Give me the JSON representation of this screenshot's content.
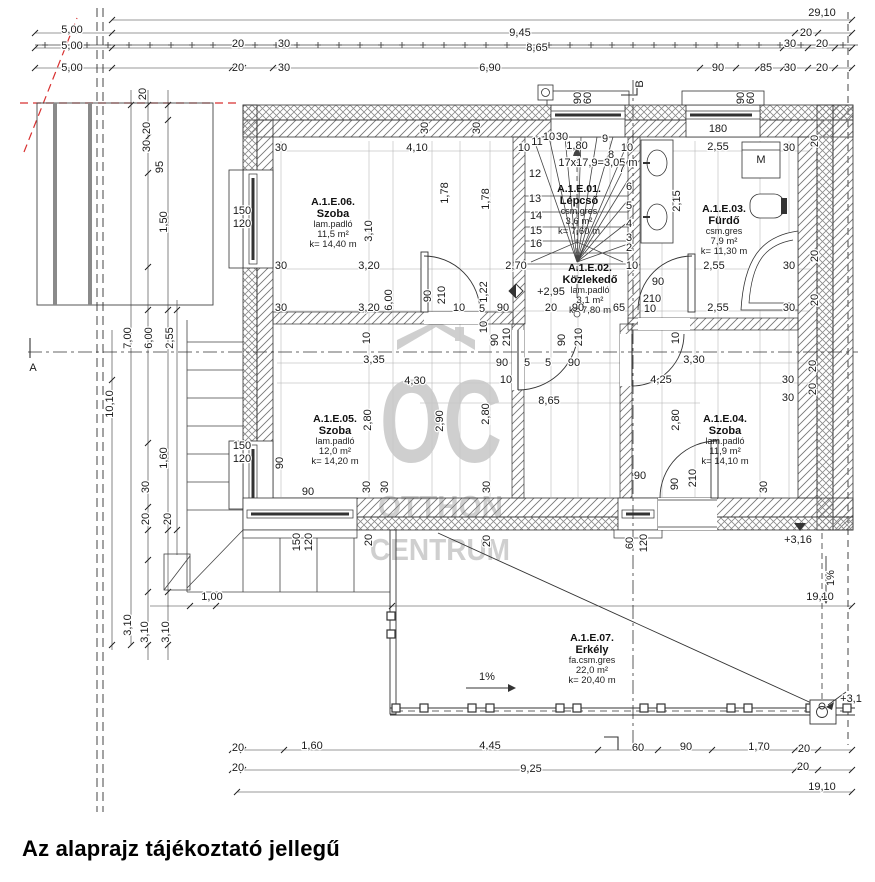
{
  "caption": "Az alaprajz tájékoztató jellegű",
  "watermark": {
    "icon": "house-roof-icon",
    "logo": "OC",
    "line1": "OTTHON",
    "line2": "CENTRUM"
  },
  "rooms": [
    {
      "code": "A.1.E.06.",
      "name": "Szoba",
      "floor": "lam.padló",
      "area": "11,5 m²",
      "perimeter": "k= 14,40 m",
      "x": 333,
      "y": 205
    },
    {
      "code": "A.1.E.01.",
      "name": "Lépcső",
      "floor": "csm.gres",
      "area": "3,6 m²",
      "perimeter": "k= 7,60 m",
      "x": 579,
      "y": 192
    },
    {
      "code": "A.1.E.03.",
      "name": "Fürdő",
      "floor": "csm.gres",
      "area": "7,9 m²",
      "perimeter": "k= 11,30 m",
      "x": 724,
      "y": 212
    },
    {
      "code": "A.1.E.02.",
      "name": "Közlekedő",
      "floor": "lam.padló",
      "area": "3,1 m²",
      "perimeter": "k= 7,80 m",
      "x": 590,
      "y": 271
    },
    {
      "code": "A.1.E.05.",
      "name": "Szoba",
      "floor": "lam.padló",
      "area": "12,0 m²",
      "perimeter": "k= 14,20 m",
      "x": 335,
      "y": 422
    },
    {
      "code": "A.1.E.04.",
      "name": "Szoba",
      "floor": "lam.padló",
      "area": "11,9 m²",
      "perimeter": "k= 14,10 m",
      "x": 725,
      "y": 422
    },
    {
      "code": "A.1.E.07.",
      "name": "Erkély",
      "floor": "fa.csm.gres",
      "area": "22,0 m²",
      "perimeter": "k= 20,40 m",
      "x": 592,
      "y": 641
    }
  ],
  "dims": [
    {
      "t": "29,10",
      "x": 822,
      "y": 16
    },
    {
      "t": "9,45",
      "x": 520,
      "y": 36
    },
    {
      "t": "20",
      "x": 806,
      "y": 36
    },
    {
      "t": "8,65",
      "x": 537,
      "y": 51
    },
    {
      "t": "30",
      "x": 790,
      "y": 47
    },
    {
      "t": "20",
      "x": 822,
      "y": 47
    },
    {
      "t": "5,00",
      "x": 72,
      "y": 33
    },
    {
      "t": "5,00",
      "x": 72,
      "y": 49
    },
    {
      "t": "5,00",
      "x": 72,
      "y": 71
    },
    {
      "t": "20",
      "x": 238,
      "y": 47
    },
    {
      "t": "30",
      "x": 284,
      "y": 47
    },
    {
      "t": "20",
      "x": 238,
      "y": 71
    },
    {
      "t": "30",
      "x": 284,
      "y": 71
    },
    {
      "t": "6,90",
      "x": 490,
      "y": 71
    },
    {
      "t": "90",
      "x": 718,
      "y": 71
    },
    {
      "t": "85",
      "x": 766,
      "y": 71
    },
    {
      "t": "30",
      "x": 790,
      "y": 71
    },
    {
      "t": "20",
      "x": 822,
      "y": 71
    },
    {
      "t": "90",
      "x": 581,
      "y": 98,
      "r": 1,
      "f": 8.5
    },
    {
      "t": "60",
      "x": 591,
      "y": 98,
      "r": 1,
      "f": 8.5
    },
    {
      "t": "90",
      "x": 744,
      "y": 98,
      "r": 1,
      "f": 8.5
    },
    {
      "t": "60",
      "x": 754,
      "y": 98,
      "r": 1,
      "f": 8.5
    },
    {
      "t": "B",
      "x": 643,
      "y": 84,
      "r": 1,
      "f": 12,
      "n": "section-marker-b"
    },
    {
      "t": "A",
      "x": 33,
      "y": 371,
      "f": 12,
      "n": "section-marker-a"
    },
    {
      "t": "20",
      "x": 146,
      "y": 94,
      "r": 1
    },
    {
      "t": "20",
      "x": 150,
      "y": 128,
      "r": 1
    },
    {
      "t": "30",
      "x": 150,
      "y": 146,
      "r": 1
    },
    {
      "t": "95",
      "x": 163,
      "y": 167,
      "r": 1
    },
    {
      "t": "1,50",
      "x": 167,
      "y": 222,
      "r": 1
    },
    {
      "t": "7,00",
      "x": 131,
      "y": 338,
      "r": 1
    },
    {
      "t": "6,00",
      "x": 152,
      "y": 338,
      "r": 1
    },
    {
      "t": "2,55",
      "x": 173,
      "y": 338,
      "r": 1
    },
    {
      "t": "10,10",
      "x": 113,
      "y": 404,
      "r": 1
    },
    {
      "t": "1,60",
      "x": 167,
      "y": 458,
      "r": 1
    },
    {
      "t": "30",
      "x": 149,
      "y": 487,
      "r": 1
    },
    {
      "t": "20",
      "x": 149,
      "y": 519,
      "r": 1
    },
    {
      "t": "20",
      "x": 171,
      "y": 519,
      "r": 1
    },
    {
      "t": "3,10",
      "x": 131,
      "y": 625,
      "r": 1
    },
    {
      "t": "3,10",
      "x": 148,
      "y": 632,
      "r": 1
    },
    {
      "t": "3,10",
      "x": 169,
      "y": 632,
      "r": 1
    },
    {
      "t": "30",
      "x": 281,
      "y": 151
    },
    {
      "t": "4,10",
      "x": 417,
      "y": 151
    },
    {
      "t": "30",
      "x": 428,
      "y": 128,
      "r": 1
    },
    {
      "t": "30",
      "x": 480,
      "y": 128,
      "r": 1
    },
    {
      "t": "10",
      "x": 524,
      "y": 151
    },
    {
      "t": "1,80",
      "x": 577,
      "y": 149
    },
    {
      "t": "10",
      "x": 627,
      "y": 151
    },
    {
      "t": "2,55",
      "x": 718,
      "y": 150
    },
    {
      "t": "30",
      "x": 789,
      "y": 151
    },
    {
      "t": "180",
      "x": 718,
      "y": 132,
      "f": 8.5
    },
    {
      "t": "20",
      "x": 818,
      "y": 141,
      "r": 1
    },
    {
      "t": "17x17,9=3,05 m",
      "x": 598,
      "y": 166,
      "f": 10.5
    },
    {
      "t": "1,78",
      "x": 448,
      "y": 193,
      "r": 1
    },
    {
      "t": "1,78",
      "x": 489,
      "y": 199,
      "r": 1
    },
    {
      "t": "2,15",
      "x": 680,
      "y": 201,
      "r": 1
    },
    {
      "t": "3,10",
      "x": 372,
      "y": 231,
      "r": 1
    },
    {
      "t": "150",
      "x": 242,
      "y": 214,
      "f": 8.5
    },
    {
      "t": "120",
      "x": 242,
      "y": 227,
      "f": 8.5
    },
    {
      "t": "30",
      "x": 281,
      "y": 269
    },
    {
      "t": "3,20",
      "x": 369,
      "y": 269
    },
    {
      "t": "2,70",
      "x": 516,
      "y": 269
    },
    {
      "t": "10",
      "x": 632,
      "y": 269
    },
    {
      "t": "2,55",
      "x": 714,
      "y": 269
    },
    {
      "t": "30",
      "x": 789,
      "y": 269
    },
    {
      "t": "20",
      "x": 818,
      "y": 256,
      "r": 1
    },
    {
      "t": "90",
      "x": 658,
      "y": 285,
      "f": 9.5
    },
    {
      "t": "210",
      "x": 652,
      "y": 302,
      "f": 9.5
    },
    {
      "t": "10",
      "x": 650,
      "y": 312,
      "f": 9.5
    },
    {
      "t": "90",
      "x": 431,
      "y": 296,
      "r": 1,
      "f": 9.5
    },
    {
      "t": "210",
      "x": 445,
      "y": 295,
      "r": 1,
      "f": 9.5
    },
    {
      "t": "10",
      "x": 459,
      "y": 311,
      "f": 9.5
    },
    {
      "t": "6,00",
      "x": 392,
      "y": 300,
      "r": 1
    },
    {
      "t": "1,22",
      "x": 487,
      "y": 292,
      "r": 1
    },
    {
      "t": "+2,95",
      "x": 551,
      "y": 295,
      "f": 11.5,
      "n": "elevation-mark"
    },
    {
      "t": "30",
      "x": 281,
      "y": 311
    },
    {
      "t": "3,20",
      "x": 369,
      "y": 311
    },
    {
      "t": "90",
      "x": 503,
      "y": 311
    },
    {
      "t": "20",
      "x": 551,
      "y": 311
    },
    {
      "t": "90",
      "x": 578,
      "y": 311
    },
    {
      "t": "65",
      "x": 619,
      "y": 311
    },
    {
      "t": "5",
      "x": 482,
      "y": 312,
      "f": 9
    },
    {
      "t": "2,55",
      "x": 718,
      "y": 311
    },
    {
      "t": "30",
      "x": 789,
      "y": 311
    },
    {
      "t": "20",
      "x": 818,
      "y": 300,
      "r": 1
    },
    {
      "t": "10",
      "x": 487,
      "y": 327,
      "r": 1,
      "f": 9.5
    },
    {
      "t": "90",
      "x": 498,
      "y": 340,
      "r": 1,
      "f": 9.5
    },
    {
      "t": "210",
      "x": 510,
      "y": 337,
      "r": 1,
      "f": 9.5
    },
    {
      "t": "90",
      "x": 565,
      "y": 340,
      "r": 1,
      "f": 9.5
    },
    {
      "t": "210",
      "x": 582,
      "y": 337,
      "r": 1,
      "f": 9.5
    },
    {
      "t": "90",
      "x": 502,
      "y": 366
    },
    {
      "t": "5",
      "x": 527,
      "y": 366,
      "f": 9
    },
    {
      "t": "5",
      "x": 548,
      "y": 366,
      "f": 9
    },
    {
      "t": "90",
      "x": 574,
      "y": 366
    },
    {
      "t": "10",
      "x": 506,
      "y": 383,
      "f": 9.5
    },
    {
      "t": "3,35",
      "x": 374,
      "y": 363
    },
    {
      "t": "10",
      "x": 370,
      "y": 338,
      "r": 1,
      "f": 9.5
    },
    {
      "t": "3,30",
      "x": 694,
      "y": 363
    },
    {
      "t": "10",
      "x": 679,
      "y": 338,
      "r": 1,
      "f": 9.5
    },
    {
      "t": "4,30",
      "x": 415,
      "y": 384
    },
    {
      "t": "4,25",
      "x": 661,
      "y": 383
    },
    {
      "t": "30",
      "x": 788,
      "y": 383
    },
    {
      "t": "30",
      "x": 788,
      "y": 401
    },
    {
      "t": "8,65",
      "x": 549,
      "y": 404
    },
    {
      "t": "20",
      "x": 816,
      "y": 366,
      "r": 1
    },
    {
      "t": "20",
      "x": 816,
      "y": 389,
      "r": 1
    },
    {
      "t": "2,80",
      "x": 371,
      "y": 420,
      "r": 1
    },
    {
      "t": "2,90",
      "x": 443,
      "y": 421,
      "r": 1
    },
    {
      "t": "2,80",
      "x": 489,
      "y": 414,
      "r": 1
    },
    {
      "t": "2,80",
      "x": 679,
      "y": 420,
      "r": 1
    },
    {
      "t": "150",
      "x": 242,
      "y": 449,
      "f": 8.5
    },
    {
      "t": "120",
      "x": 242,
      "y": 462,
      "f": 8.5
    },
    {
      "t": "90",
      "x": 283,
      "y": 463,
      "r": 1,
      "f": 8.5
    },
    {
      "t": "90",
      "x": 308,
      "y": 495,
      "f": 8.5
    },
    {
      "t": "30",
      "x": 370,
      "y": 487,
      "r": 1
    },
    {
      "t": "30",
      "x": 388,
      "y": 487,
      "r": 1
    },
    {
      "t": "30",
      "x": 490,
      "y": 487,
      "r": 1
    },
    {
      "t": "30",
      "x": 767,
      "y": 487,
      "r": 1
    },
    {
      "t": "20",
      "x": 372,
      "y": 540,
      "r": 1
    },
    {
      "t": "20",
      "x": 490,
      "y": 541,
      "r": 1
    },
    {
      "t": "90",
      "x": 640,
      "y": 479,
      "f": 8.5
    },
    {
      "t": "60",
      "x": 633,
      "y": 543,
      "r": 1,
      "f": 8.5
    },
    {
      "t": "120",
      "x": 647,
      "y": 543,
      "r": 1,
      "f": 8.5
    },
    {
      "t": "150",
      "x": 300,
      "y": 542,
      "r": 1,
      "f": 8.5
    },
    {
      "t": "120",
      "x": 312,
      "y": 542,
      "r": 1,
      "f": 8.5
    },
    {
      "t": "90",
      "x": 678,
      "y": 484,
      "r": 1,
      "f": 9.5
    },
    {
      "t": "210",
      "x": 696,
      "y": 478,
      "r": 1,
      "f": 9.5
    },
    {
      "t": "+3,16",
      "x": 798,
      "y": 543,
      "f": 11.5,
      "n": "elevation-mark"
    },
    {
      "t": "19,10",
      "x": 820,
      "y": 600
    },
    {
      "t": "1,00",
      "x": 212,
      "y": 600
    },
    {
      "t": "1%",
      "x": 834,
      "y": 578,
      "r": 1,
      "f": 9,
      "n": "slope-label"
    },
    {
      "t": "+3,1",
      "x": 851,
      "y": 702,
      "f": 11.5,
      "n": "elevation-mark"
    },
    {
      "t": "1%",
      "x": 487,
      "y": 680,
      "f": 9.5,
      "n": "slope-label"
    },
    {
      "t": "20",
      "x": 238,
      "y": 751
    },
    {
      "t": "1,60",
      "x": 312,
      "y": 749
    },
    {
      "t": "4,45",
      "x": 490,
      "y": 749
    },
    {
      "t": "60",
      "x": 638,
      "y": 751
    },
    {
      "t": "90",
      "x": 686,
      "y": 750
    },
    {
      "t": "1,70",
      "x": 759,
      "y": 750
    },
    {
      "t": "20",
      "x": 804,
      "y": 752
    },
    {
      "t": "20",
      "x": 238,
      "y": 771
    },
    {
      "t": "9,25",
      "x": 531,
      "y": 772
    },
    {
      "t": "20",
      "x": 803,
      "y": 770
    },
    {
      "t": "19,10",
      "x": 822,
      "y": 790
    },
    {
      "t": "11",
      "x": 537,
      "y": 145,
      "f": 8,
      "n": "stair-tread-number"
    },
    {
      "t": "12",
      "x": 535,
      "y": 177,
      "f": 8,
      "n": "stair-tread-number"
    },
    {
      "t": "13",
      "x": 535,
      "y": 202,
      "f": 8,
      "n": "stair-tread-number"
    },
    {
      "t": "14",
      "x": 536,
      "y": 219,
      "f": 8,
      "n": "stair-tread-number"
    },
    {
      "t": "15",
      "x": 536,
      "y": 234,
      "f": 8,
      "n": "stair-tread-number"
    },
    {
      "t": "16",
      "x": 536,
      "y": 247,
      "f": 8,
      "n": "stair-tread-number"
    },
    {
      "t": "9",
      "x": 605,
      "y": 142,
      "f": 8,
      "n": "stair-tread-number"
    },
    {
      "t": "8",
      "x": 611,
      "y": 158,
      "f": 8,
      "n": "stair-tread-number"
    },
    {
      "t": "7",
      "x": 622,
      "y": 172,
      "f": 8,
      "n": "stair-tread-number"
    },
    {
      "t": "6",
      "x": 629,
      "y": 190,
      "f": 8,
      "n": "stair-tread-number"
    },
    {
      "t": "5",
      "x": 629,
      "y": 209,
      "f": 8,
      "n": "stair-tread-number"
    },
    {
      "t": "4",
      "x": 629,
      "y": 227,
      "f": 8,
      "n": "stair-tread-number"
    },
    {
      "t": "3",
      "x": 629,
      "y": 241,
      "f": 8,
      "n": "stair-tread-number"
    },
    {
      "t": "2",
      "x": 629,
      "y": 251,
      "f": 8,
      "n": "stair-tread-number"
    },
    {
      "t": "30",
      "x": 562,
      "y": 140,
      "f": 8
    },
    {
      "t": "10",
      "x": 549,
      "y": 140,
      "f": 8
    },
    {
      "t": "M",
      "x": 761,
      "y": 163,
      "f": 10,
      "n": "washing-machine-label"
    }
  ]
}
